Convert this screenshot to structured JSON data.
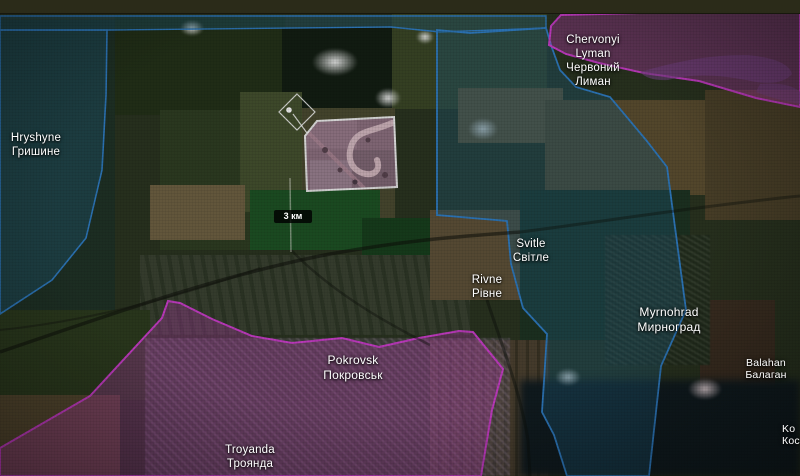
{
  "labels": {
    "hryshyne": {
      "en": "Hryshyne",
      "uk": "Гришине"
    },
    "chervonyi_lyman": {
      "en1": "Chervonyi",
      "en2": "Lyman",
      "uk1": "Червоний",
      "uk2": "Лиман"
    },
    "svitle": {
      "en": "Svitle",
      "uk": "Світле"
    },
    "rivne": {
      "en": "Rivne",
      "uk": "Рівне"
    },
    "myrnohrad": {
      "en": "Myrnohrad",
      "uk": "Мирноград"
    },
    "balahan": {
      "en": "Balahan",
      "uk": "Балаган"
    },
    "pokrovsk": {
      "en": "Pokrovsk",
      "uk": "Покровськ"
    },
    "troyanda": {
      "en": "Troyanda",
      "uk": "Троянда"
    },
    "kos_partial": {
      "en": "Ko",
      "uk": "Кос"
    }
  },
  "scale_bar": {
    "label": "3 км"
  },
  "zones": {
    "friendly": {
      "fill": "#1e5a78",
      "stroke": "#2f7ec7"
    },
    "hostile": {
      "fill": "#c840c0",
      "stroke": "#cf3ecf"
    }
  },
  "marker": {
    "type": "diamond-poi"
  }
}
